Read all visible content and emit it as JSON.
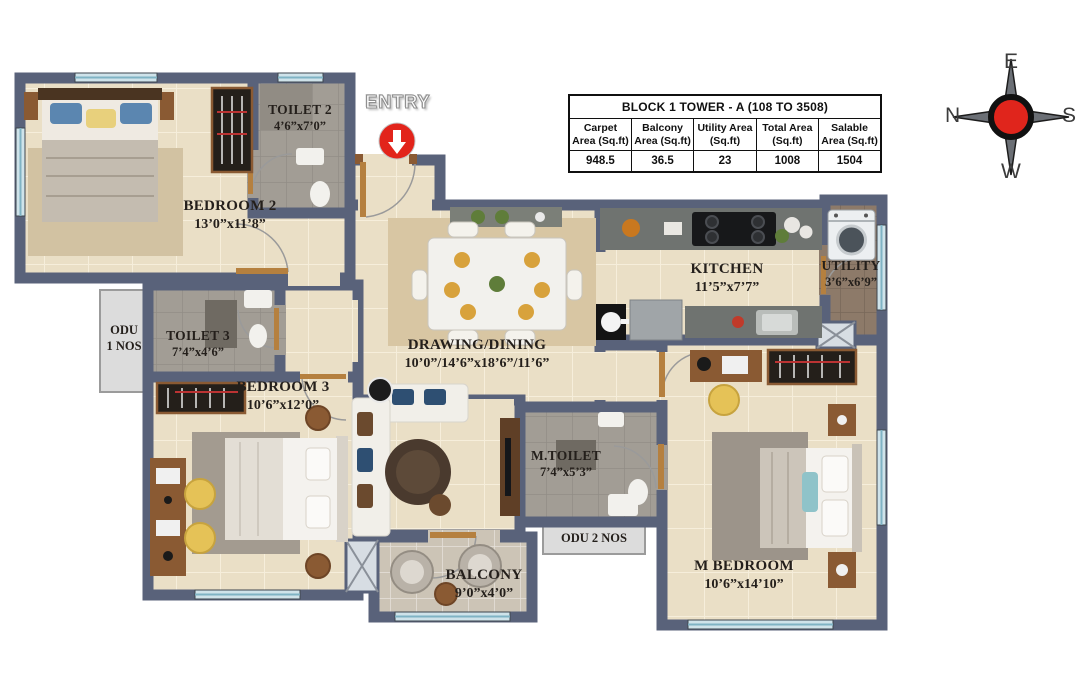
{
  "info_table": {
    "title": "BLOCK 1 TOWER - A (108 TO 3508)",
    "columns": [
      {
        "label": "Carpet Area (Sq.ft)",
        "value": "948.5"
      },
      {
        "label": "Balcony Area (Sq.ft)",
        "value": "36.5"
      },
      {
        "label": "Utility Area (Sq.ft)",
        "value": "23"
      },
      {
        "label": "Total Area (Sq.ft)",
        "value": "1008"
      },
      {
        "label": "Salable Area (Sq.ft)",
        "value": "1504"
      }
    ]
  },
  "entry": {
    "label": "ENTRY"
  },
  "compass": {
    "north": "N",
    "east": "E",
    "south": "S",
    "west": "W"
  },
  "rooms": [
    {
      "name": "BEDROOM 2",
      "dims": "13’0”x11’8”"
    },
    {
      "name": "TOILET 2",
      "dims": "4’6”x7’0”"
    },
    {
      "name": "KITCHEN",
      "dims": "11’5”x7’7”"
    },
    {
      "name": "UTILITY",
      "dims": "3’6”x6’9”"
    },
    {
      "name": "TOILET 3",
      "dims": "7’4”x4’6”"
    },
    {
      "name": "BEDROOM 3",
      "dims": "10’6”x12’0”"
    },
    {
      "name": "DRAWING/DINING",
      "dims": "10’0”/14’6”x18’6”/11’6”"
    },
    {
      "name": "M.TOILET",
      "dims": "7’4”x5’3”"
    },
    {
      "name": "BALCONY",
      "dims": "9’0”x4’0”"
    },
    {
      "name": "M BEDROOM",
      "dims": "10’6”x14’10”"
    }
  ],
  "odu": {
    "odu1_line1": "ODU",
    "odu1_line2": "1 NOS",
    "odu2": "ODU 2 NOS"
  },
  "colors": {
    "wall": "#59627a",
    "floor": "#eadfc6",
    "entry_red": "#e2241b",
    "compass_red": "#e0251c"
  }
}
